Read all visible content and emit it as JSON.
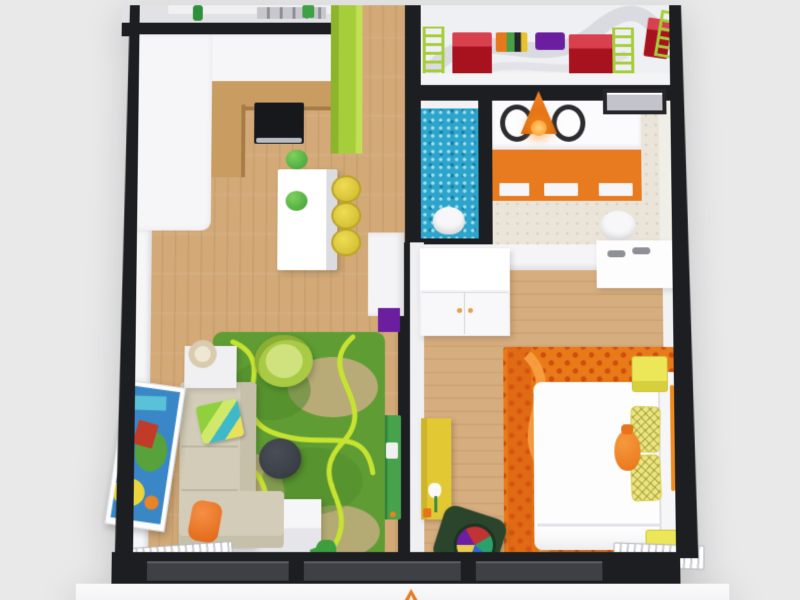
{
  "image": {
    "type": "3D floor plan render",
    "description": "Top-down 3D architectural rendering of an apartment: kitchen with island, living room with green swirl rug, hallway, kids room, blue-mosaic WC, bathroom with double vanity and orange pendant, and bedroom with white bed on an orange rug; light gray backdrop",
    "background_color": "#e9e9ea"
  },
  "palette": {
    "outer_wall": "#1d1e22",
    "inner_wall": "#f6f6f8",
    "wood_floor": "#d2a977",
    "lime_green": "#a6ce3a",
    "door_green": "#3f9e47",
    "rug_green": "#5f9c33",
    "swirl_lime": "#c6e332",
    "mosaic_blue": "#2da4cb",
    "accent_orange": "#e87a1f",
    "rug_orange": "#e87818",
    "rug_orange_dark": "#cf4d10",
    "stool_yellow": "#e2cb39",
    "cube_yellow": "#ece659",
    "pillow_yellow": "#eae584",
    "sofa_beige": "#d2ccb8",
    "table_charcoal": "#3b3f46",
    "kids_red": "#bf1f2d",
    "purple": "#6b1fa0",
    "chair_dark_green": "#2b452d"
  },
  "rooms": {
    "utility": "Utility room (cropped at top edge)",
    "kitchen": "Kitchen",
    "kids_room": "Kids room (cropped at top edge)",
    "wc": "WC with blue mosaic floor",
    "bathroom": "Bathroom",
    "hallway": "Hallway",
    "living_room": "Living room",
    "bedroom": "Bedroom"
  },
  "objects": {
    "kitchen_island": "White kitchen island",
    "bar_stools": "Three yellow bar stools",
    "cooktop": "Black cooktop with hood",
    "green_bowl": "Green bowl",
    "lime_cabinet": "Lime green tall cabinet",
    "kitchen_counter": "Wooden kitchen counter",
    "sofa": "L-shaped beige sofa",
    "striped_pillow": "Green and teal striped pillow",
    "orange_pillow": "Orange pillow",
    "side_table": "White side table with lamp",
    "lime_armchair": "Lime green tub armchair",
    "coffee_table": "Round charcoal coffee table",
    "green_rug": "Green rug with lime swirl pattern",
    "wall_art": "Colorful framed wall art",
    "tv_cabinet": "White low cabinet",
    "watering_can": "Green watering can",
    "radiator": "White radiator",
    "console": "White hallway console with purple base",
    "green_door": "Green interior door",
    "mosaic_floor": "Blue mosaic WC floor",
    "toilet": "White toilet",
    "vanity": "Double-sink vanity with orange drawers",
    "pendant_lamp": "Orange cone pendant lamp",
    "window": "Window",
    "wardrobe": "White wardrobe",
    "ceiling_panel": "White ceiling panel with spotlights",
    "bed": "White double bed",
    "quilted_pillows": "Yellow quilted pillows",
    "orange_cushion": "Orange vase-shaped cushion",
    "orange_rug": "Orange patterned rug",
    "nightstand": "Yellow cube nightstand",
    "yellow_dresser": "Yellow dresser with tulip decal",
    "dark_green_chair": "Dark green chair with multicolor cushion",
    "kids_bed": "Red kids bunk with lime ladder",
    "toy_box": "Multicolor toy box",
    "purple_mat": "Purple floor mat",
    "exterior_windows": "Dark exterior window band",
    "logo_mark": "Orange watermark glyph"
  }
}
